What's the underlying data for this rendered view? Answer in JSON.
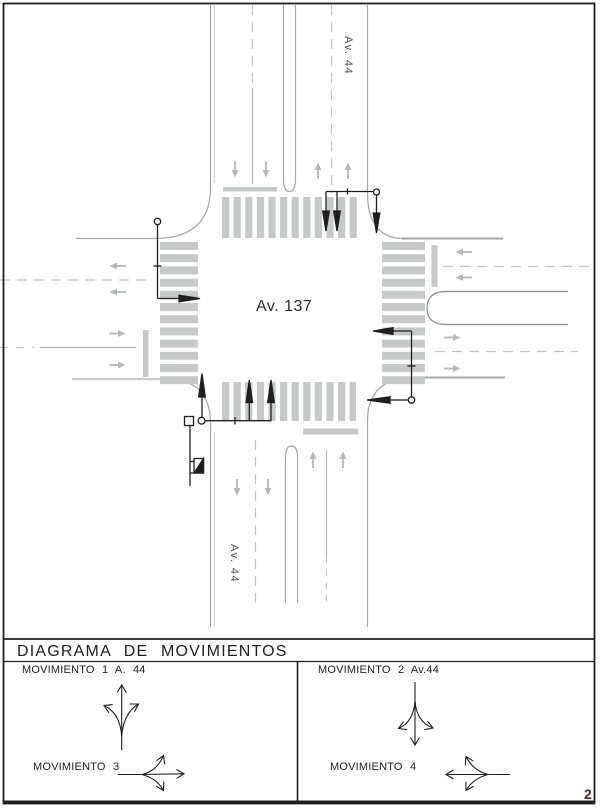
{
  "page": {
    "number": "2"
  },
  "plan": {
    "main_road_label": "Av. 137",
    "cross_road_top_label": "Av. 44",
    "cross_road_bottom_label": "Av. 44"
  },
  "movements": {
    "title": "DIAGRAMA DE MOVIMIENTOS",
    "movement1": "MOVIMIENTO 1 A. 44",
    "movement2": "MOVIMIENTO 2 Av.44",
    "movement3": "MOVIMIENTO 3",
    "movement4": "MOVIMIENTO 4"
  },
  "colors": {
    "ink": "#1f1f1f",
    "road_edge_gray": "#a6a6a6",
    "stripe_gray": "#c6c9ca",
    "arrow_gray": "#b3b8ba"
  }
}
